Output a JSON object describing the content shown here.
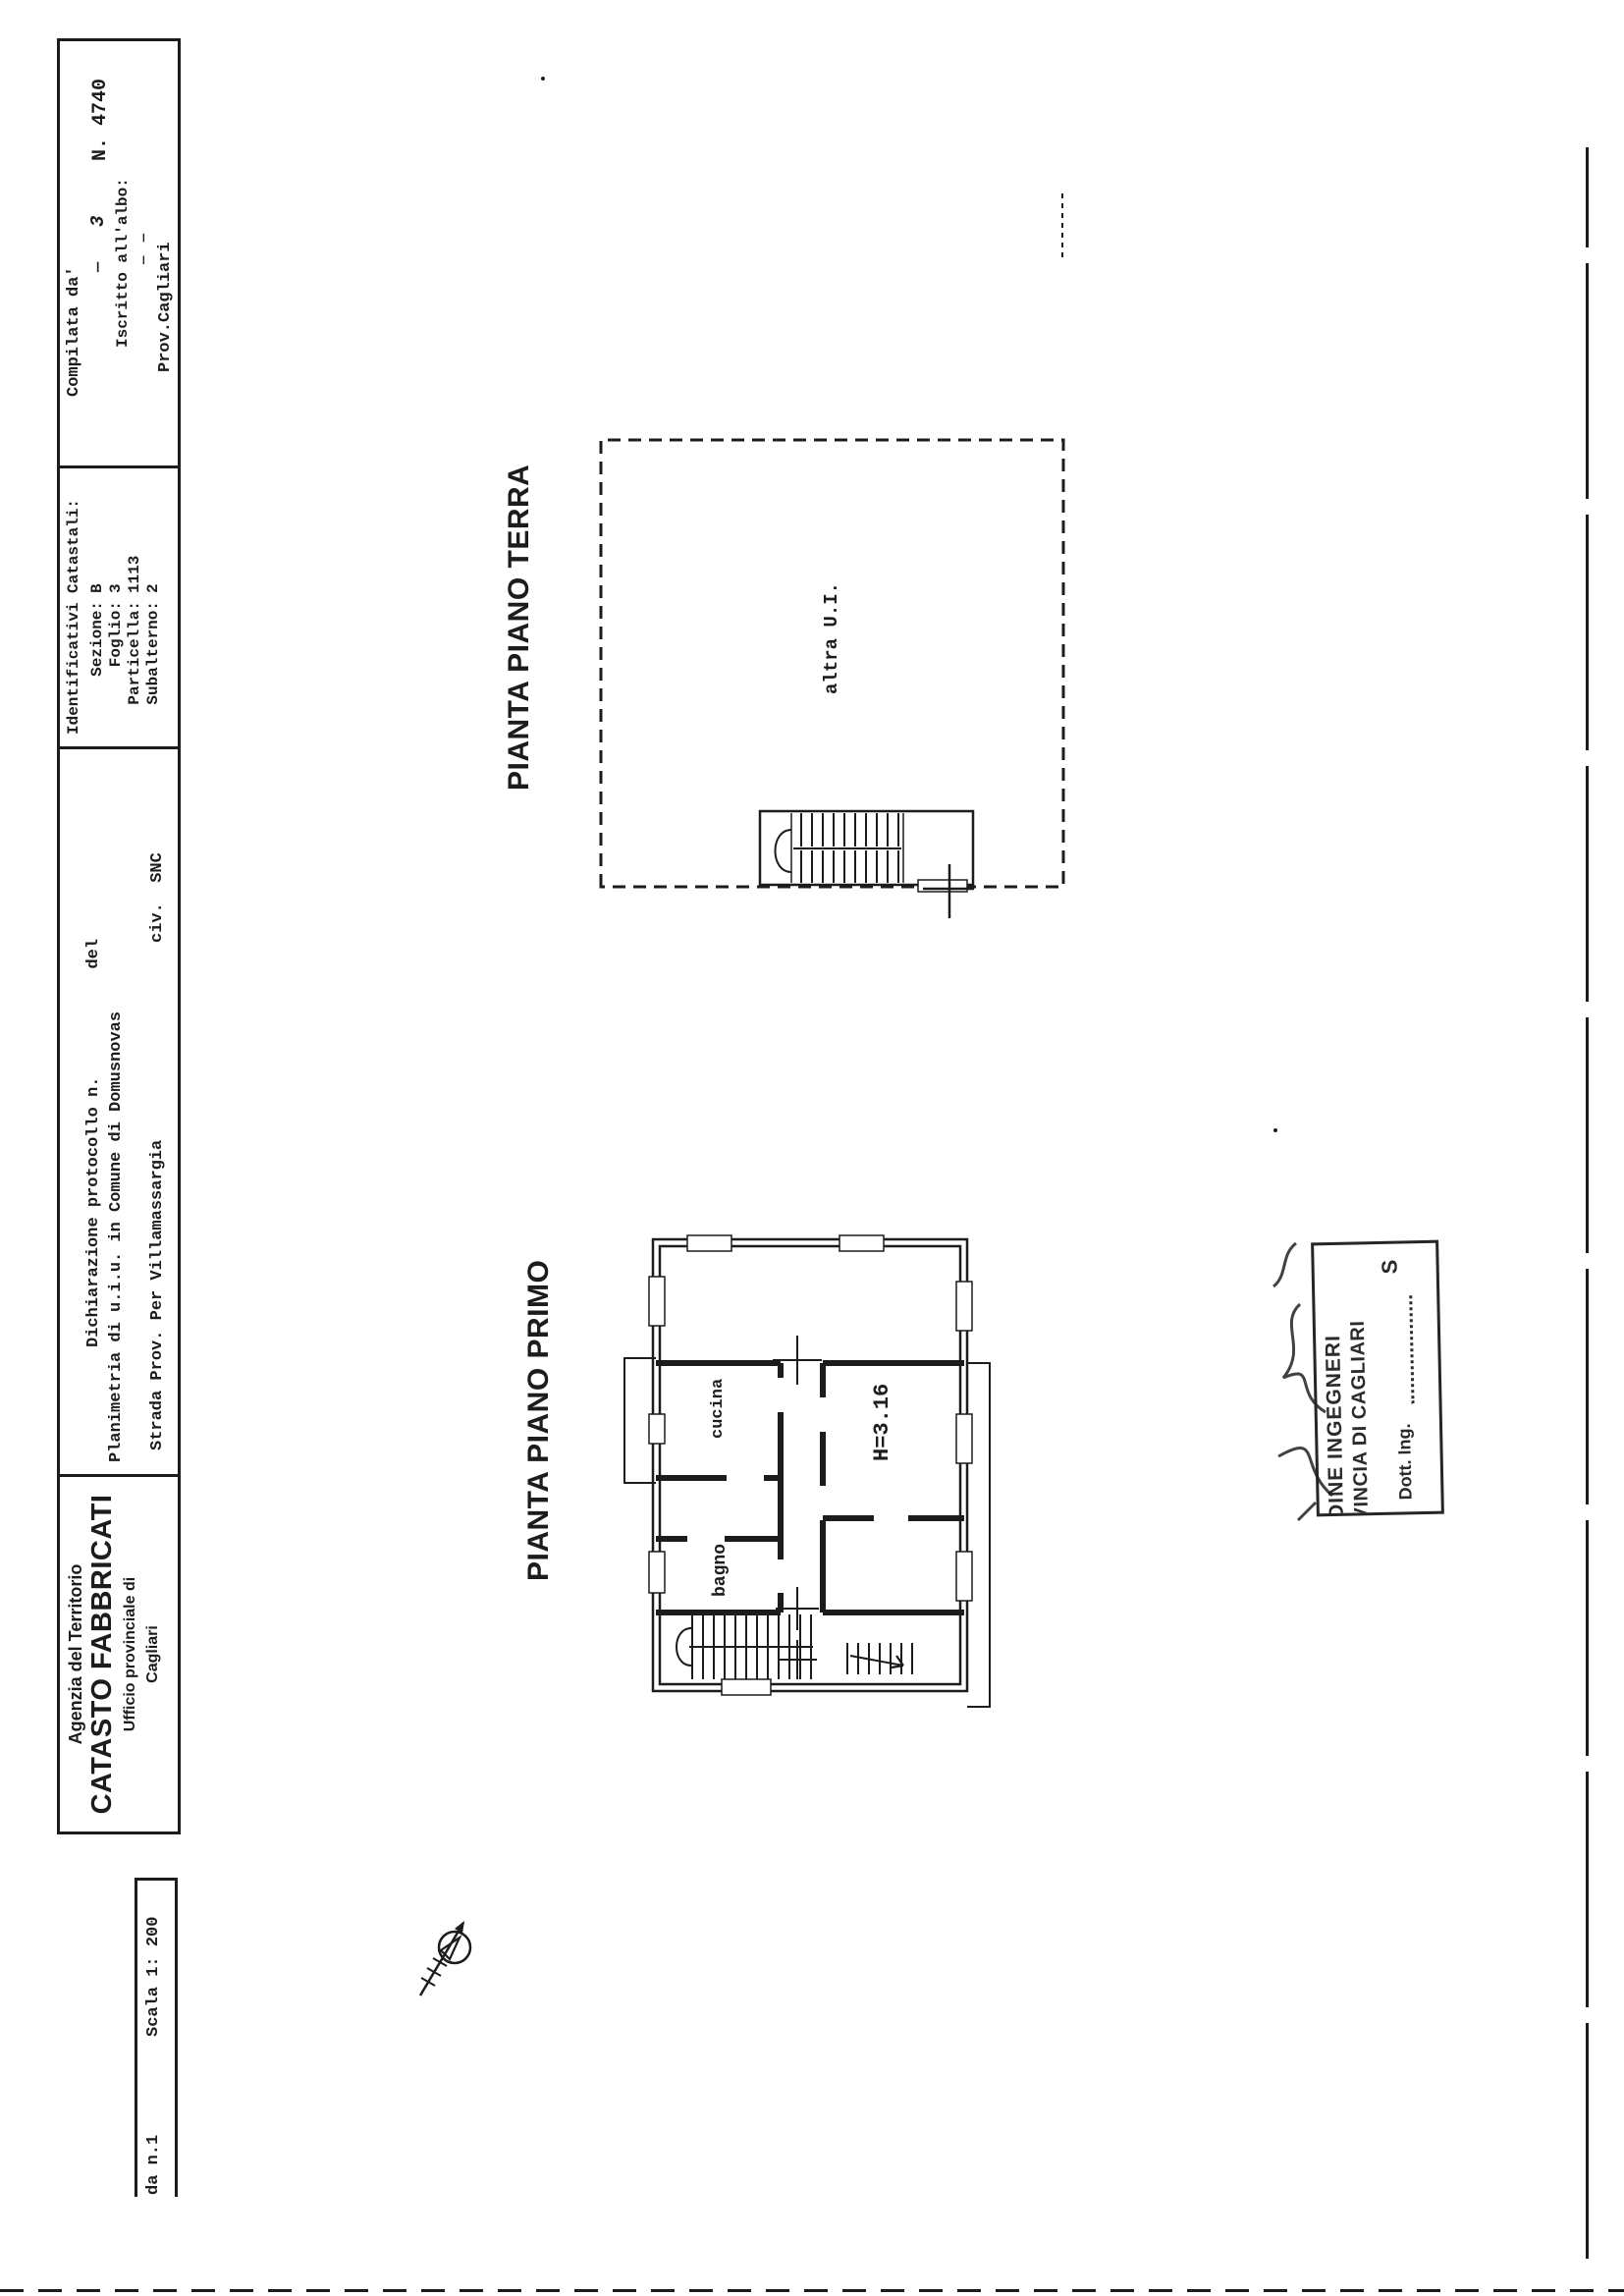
{
  "colors": {
    "paper": "#ffffff",
    "ink": "#1c1c1c"
  },
  "header_table": {
    "agency_cell": {
      "line1": "Agenzia del Territorio",
      "line2": "CATASTO FABBRICATI",
      "line3": "Ufficio provinciale di",
      "line4": "Cagliari"
    },
    "declaration_cell": {
      "protocol_label": "Dichiarazione protocollo n.",
      "protocol_del": "del",
      "planimetry_line": "Planimetria di u.i.u. in Comune di Domusnovas",
      "street_line": "Strada Prov. Per Villamassargia",
      "civic_label": "civ.  SNC"
    },
    "cadastral_cell": {
      "title": "Identificativi Catastali:",
      "fields": [
        {
          "label": "Sezione:",
          "value": "B"
        },
        {
          "label": "Foglio:",
          "value": "3"
        },
        {
          "label": "Particella:",
          "value": "1113"
        },
        {
          "label": "Subalterno:",
          "value": "2"
        }
      ]
    },
    "compiler_cell": {
      "compiled_by": "Compilata da'",
      "fill_mark": "—",
      "script_mark": "3",
      "number": "N. 4740",
      "register_label": "Iscritto all'albo:",
      "register_fill": "— —",
      "province": "Prov.Cagliari"
    }
  },
  "scale_strip": {
    "sheet_label": "da n.1",
    "scale_label": "Scala 1: 200"
  },
  "ground_floor": {
    "title": "PIANTA PIANO TERRA",
    "unit_label": "altra U.I."
  },
  "first_floor": {
    "title": "PIANTA PIANO PRIMO",
    "kitchen_label": "cucina",
    "bathroom_label": "bagno",
    "height_label": "H=3.16"
  },
  "stamp": {
    "line1": "DINE INGEGNERI",
    "line2": "VINCIA DI CAGLIARI",
    "line3": "Dott. Ing.",
    "mark": "S"
  }
}
